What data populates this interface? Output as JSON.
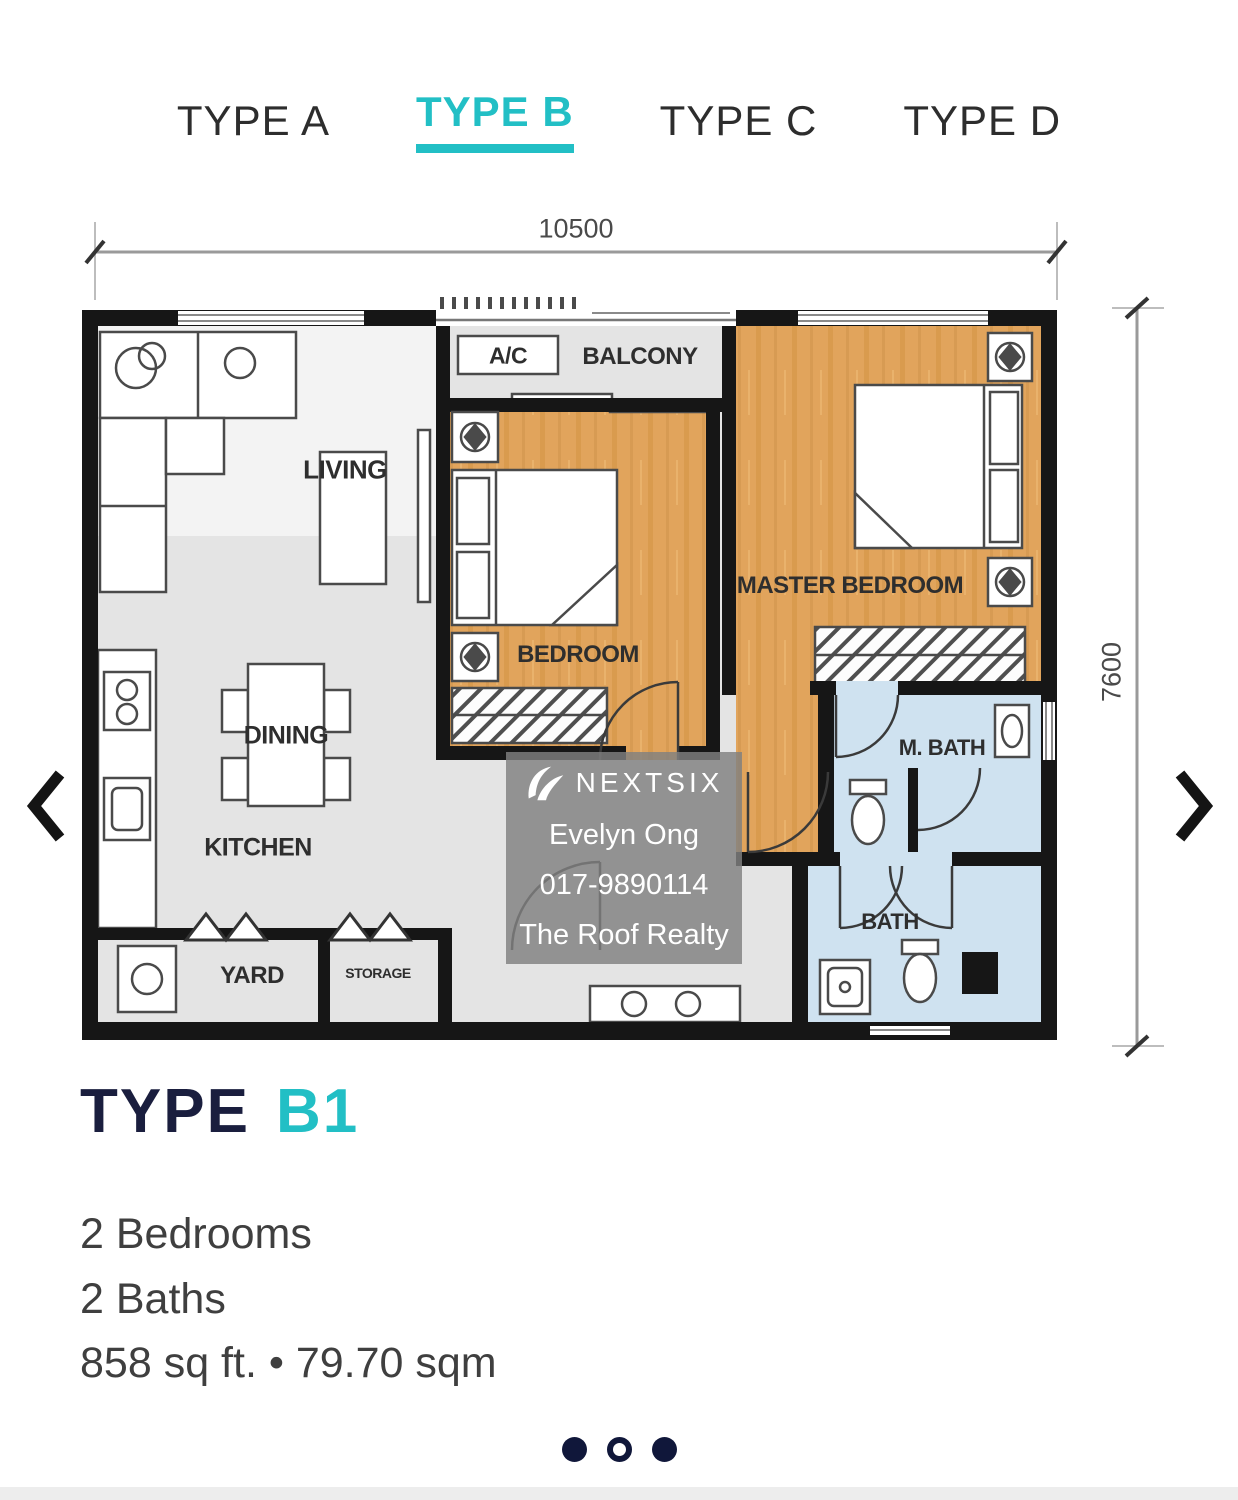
{
  "tabs": {
    "items": [
      {
        "label": "TYPE A",
        "active": false
      },
      {
        "label": "TYPE B",
        "active": true
      },
      {
        "label": "TYPE C",
        "active": false
      },
      {
        "label": "TYPE D",
        "active": false
      }
    ]
  },
  "plan": {
    "dim_width": "10500",
    "dim_height": "7600",
    "rooms": {
      "living": "LIVING",
      "balcony": "BALCONY",
      "ac": "A/C",
      "bedroom": "BEDROOM",
      "master_bedroom": "MASTER BEDROOM",
      "dining": "DINING",
      "kitchen": "KITCHEN",
      "yard": "YARD",
      "storage": "STORAGE",
      "m_bath": "M. BATH",
      "bath": "BATH"
    }
  },
  "watermark": {
    "brand": "NEXTSIX",
    "agent": "Evelyn Ong",
    "phone": "017-9890114",
    "agency": "The Roof Realty"
  },
  "unit": {
    "title_main": "TYPE",
    "title_accent": "B1",
    "bedrooms": "2 Bedrooms",
    "baths": "2 Baths",
    "area": "858 sq ft. • 79.70 sqm"
  },
  "carousel": {
    "dots": [
      "filled",
      "outline",
      "filled"
    ]
  },
  "colors": {
    "accent_teal": "#22bfc5",
    "title_navy": "#1a1e3e",
    "dot_navy": "#10173a",
    "wood_floor": "#e1a45c",
    "bath_blue": "#cfe2f0",
    "floor_gray": "#e4e4e4",
    "wall_black": "#161616"
  }
}
